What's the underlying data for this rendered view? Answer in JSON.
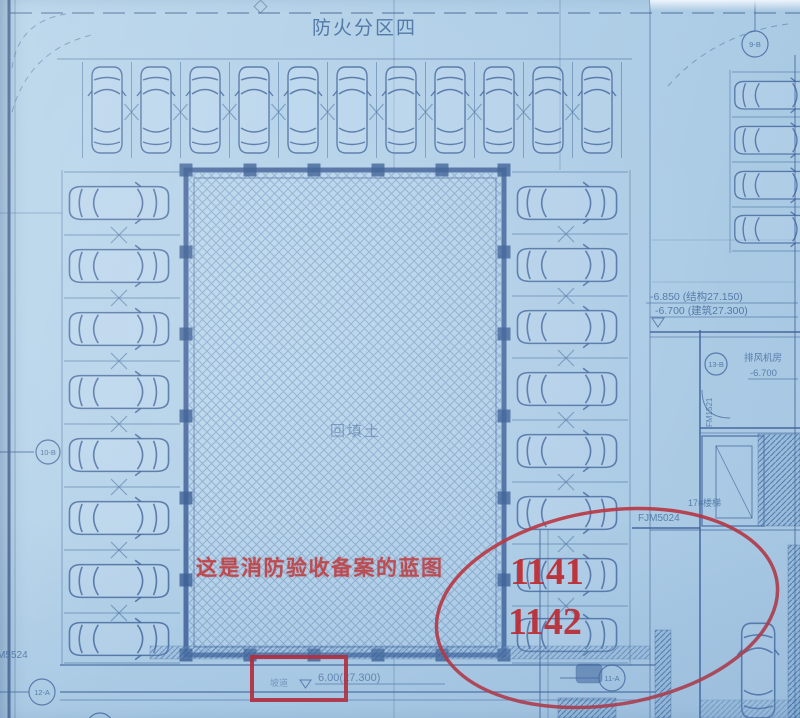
{
  "plan": {
    "fire_zone": "防火分区四",
    "backfill": "回填土",
    "elevation1": "-6.850 (结构27.150)",
    "elevation2": "-6.700 (建筑27.300)",
    "door_tag_right": "FJM5024",
    "door_tag_left": "FJM5524",
    "fan_room": "排风机房",
    "fan_room_elevation": "-6.700",
    "stair": "17#楼梯",
    "ramp": "坡道",
    "bottom_elevation": "6.00(27.300)",
    "door_tag_vertical": "FM1521",
    "bubbles": {
      "left": "10-B",
      "top_right": "9-B",
      "right": "13-B",
      "bottom": "11-A",
      "bottom_left": "12-A"
    }
  },
  "annotations": {
    "note": "这是消防验收备案的蓝图",
    "space_1": "1141",
    "space_2": "1142"
  },
  "colors": {
    "paper": "#b4d2e9",
    "line": "#3e6698",
    "red_marker": "#c1272d",
    "red_text": "#cc1717"
  }
}
